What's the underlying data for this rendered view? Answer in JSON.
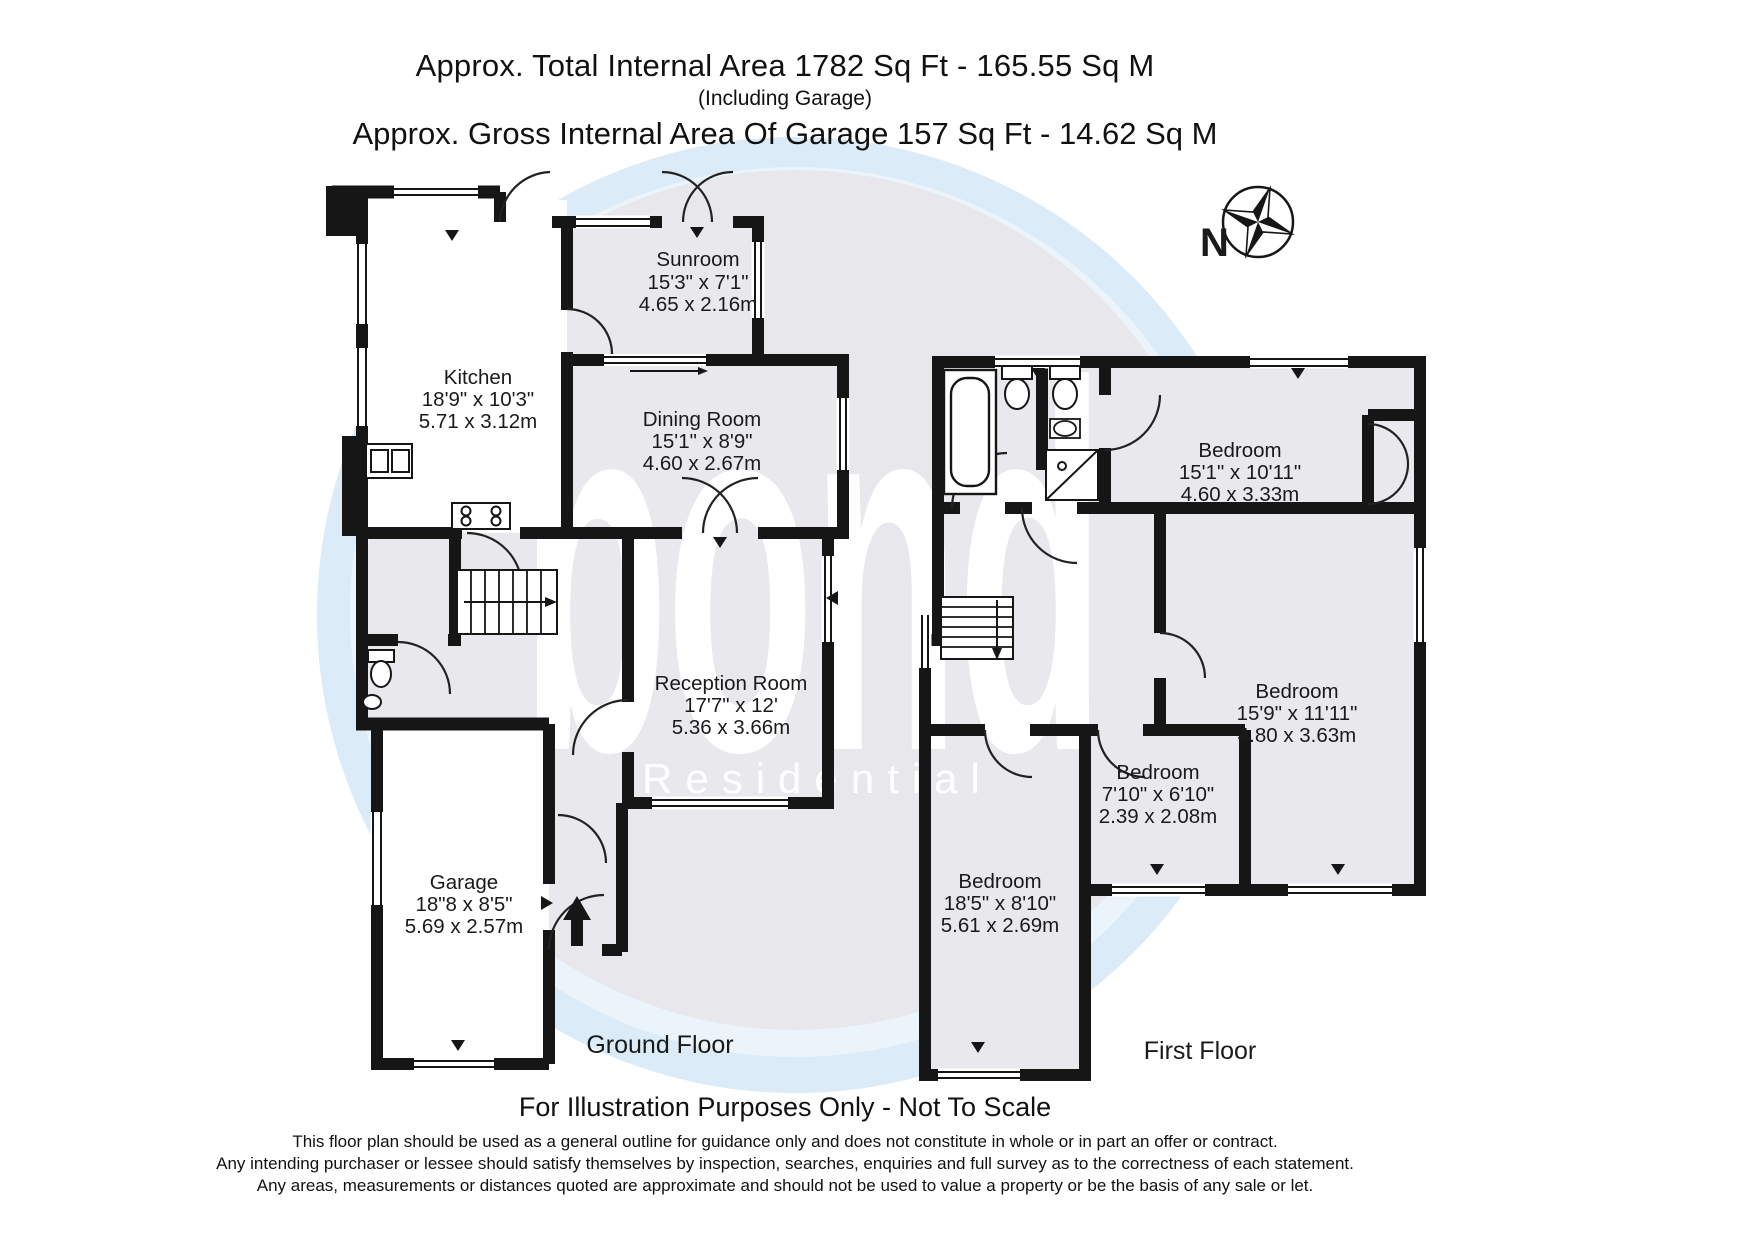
{
  "header": {
    "total_area_label": "Approx. Total Internal Area",
    "total_area_value": "1782 Sq Ft  -  165.55 Sq M",
    "including_note": "(Including Garage)",
    "garage_area_label": "Approx. Gross Internal Area Of Garage",
    "garage_area_value": "157 Sq Ft  -  14.62 Sq M",
    "total_line": "Approx. Total Internal Area   1782 Sq Ft  -  165.55 Sq M",
    "garage_line": "Approx. Gross Internal Area Of Garage  157 Sq Ft  -  14.62 Sq M"
  },
  "compass": {
    "north_label": "N"
  },
  "watermark": {
    "brand": "bond",
    "brand_sub": "Residential"
  },
  "ground_floor": {
    "floor_label": "Ground Floor",
    "sunroom": {
      "name": "Sunroom",
      "imperial": "15'3\" x 7'1\"",
      "metric": "4.65 x 2.16m"
    },
    "kitchen": {
      "name": "Kitchen",
      "imperial": "18'9\" x 10'3\"",
      "metric": "5.71 x 3.12m"
    },
    "dining": {
      "name": "Dining Room",
      "imperial": "15'1\" x 8'9\"",
      "metric": "4.60 x 2.67m"
    },
    "reception": {
      "name": "Reception Room",
      "imperial": "17'7\" x 12'",
      "metric": "5.36 x 3.66m"
    },
    "garage": {
      "name": "Garage",
      "imperial": "18\"8 x 8'5\"",
      "metric": "5.69 x 2.57m"
    }
  },
  "first_floor": {
    "floor_label": "First Floor",
    "bedroom_top": {
      "name": "Bedroom",
      "imperial": "15'1\" x 10'11\"",
      "metric": "4.60 x 3.33m"
    },
    "bedroom_right": {
      "name": "Bedroom",
      "imperial": "15'9\" x 11'11\"",
      "metric": "4.80 x 3.63m"
    },
    "bedroom_small": {
      "name": "Bedroom",
      "imperial": "7'10\" x 6'10\"",
      "metric": "2.39 x 2.08m"
    },
    "bedroom_bottom": {
      "name": "Bedroom",
      "imperial": "18'5\" x 8'10\"",
      "metric": "5.61 x 2.69m"
    }
  },
  "footer": {
    "notice": "For Illustration Purposes Only - Not To Scale",
    "disclaimer_line1": "This floor plan should be used as a general outline for guidance only and does not constitute in whole or in part an offer or contract.",
    "disclaimer_line2": "Any intending purchaser or lessee should satisfy themselves by inspection, searches, enquiries and full survey as to the correctness of each statement.",
    "disclaimer_line3": "Any areas, measurements or distances quoted are approximate and should not be used to value a property or be the basis of any sale or let."
  }
}
